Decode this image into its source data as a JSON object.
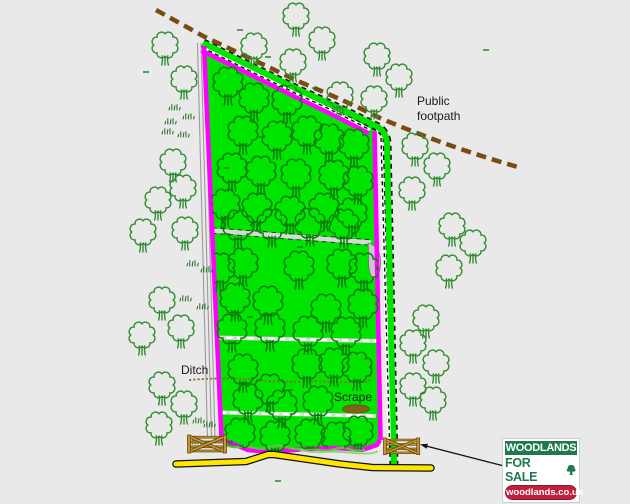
{
  "labels": [
    {
      "id": "label-public-footpath",
      "text": "Public footpath",
      "x": 417,
      "y": 94,
      "w": 60
    },
    {
      "id": "label-ditch",
      "text": "Ditch",
      "x": 181,
      "y": 363,
      "w": 42
    },
    {
      "id": "label-scrape",
      "text": "Scrape",
      "x": 334,
      "y": 390,
      "w": 50
    }
  ],
  "logo": {
    "title": "WOODLANDS",
    "subtitle": "FOR SALE",
    "url": "woodlands.co.uk"
  },
  "colors": {
    "bg": "#e9e9e9",
    "plot_green": "#00e500",
    "tree_inside": "#0a7d0a",
    "tree_outside": "#2d8c2d",
    "boundary": "#ff00ff",
    "footpath": "#7c4a12",
    "road_yellow": "#ffe600",
    "road_casing": "#111111",
    "track_grey": "#d8d8d8",
    "ditch": "#8a6d20",
    "scrub": "#5fc043",
    "gate_gold": "#c5952f",
    "gate_dark": "#553a08",
    "label_text": "#1b1b1b",
    "logo_green": "#1e7a4c",
    "logo_red": "#c2203a"
  },
  "map": {
    "tree_scale_inside": 0.92,
    "tree_scale_outside": 0.8,
    "trees_inside": [
      [
        228,
        82
      ],
      [
        254,
        98
      ],
      [
        287,
        100
      ],
      [
        243,
        131
      ],
      [
        277,
        136
      ],
      [
        307,
        131
      ],
      [
        329,
        139
      ],
      [
        354,
        144
      ],
      [
        232,
        168
      ],
      [
        261,
        171
      ],
      [
        296,
        174
      ],
      [
        334,
        175
      ],
      [
        358,
        181
      ],
      [
        225,
        204
      ],
      [
        257,
        208
      ],
      [
        290,
        211
      ],
      [
        324,
        208
      ],
      [
        352,
        213
      ],
      [
        238,
        225
      ],
      [
        272,
        224
      ],
      [
        310,
        223
      ],
      [
        344,
        224
      ],
      [
        220,
        268
      ],
      [
        243,
        263
      ],
      [
        299,
        266
      ],
      [
        342,
        264
      ],
      [
        364,
        268
      ],
      [
        235,
        298
      ],
      [
        268,
        301
      ],
      [
        326,
        309
      ],
      [
        363,
        304
      ],
      [
        232,
        329
      ],
      [
        270,
        328
      ],
      [
        308,
        331
      ],
      [
        346,
        332
      ],
      [
        243,
        369
      ],
      [
        307,
        364
      ],
      [
        334,
        363
      ],
      [
        357,
        367
      ],
      [
        270,
        389
      ],
      [
        248,
        399
      ],
      [
        282,
        405
      ],
      [
        318,
        401
      ],
      [
        240,
        433
      ],
      [
        275,
        436
      ],
      [
        310,
        434
      ],
      [
        336,
        437
      ],
      [
        358,
        431
      ]
    ],
    "trees_outside": [
      [
        165,
        45
      ],
      [
        184,
        79
      ],
      [
        254,
        46
      ],
      [
        296,
        16
      ],
      [
        293,
        62
      ],
      [
        322,
        40
      ],
      [
        377,
        56
      ],
      [
        399,
        77
      ],
      [
        340,
        95
      ],
      [
        374,
        99
      ],
      [
        173,
        162
      ],
      [
        183,
        188
      ],
      [
        158,
        200
      ],
      [
        185,
        230
      ],
      [
        143,
        232
      ],
      [
        162,
        300
      ],
      [
        142,
        335
      ],
      [
        181,
        328
      ],
      [
        162,
        385
      ],
      [
        184,
        404
      ],
      [
        159,
        425
      ],
      [
        415,
        146
      ],
      [
        437,
        166
      ],
      [
        412,
        190
      ],
      [
        452,
        226
      ],
      [
        473,
        243
      ],
      [
        449,
        268
      ],
      [
        426,
        318
      ],
      [
        413,
        343
      ],
      [
        436,
        363
      ],
      [
        413,
        386
      ],
      [
        433,
        400
      ]
    ],
    "tufts": [
      [
        175,
        107
      ],
      [
        189,
        116
      ],
      [
        171,
        121
      ],
      [
        184,
        134
      ],
      [
        168,
        131
      ],
      [
        193,
        263
      ],
      [
        207,
        269
      ],
      [
        186,
        298
      ],
      [
        203,
        306
      ],
      [
        199,
        420
      ],
      [
        210,
        424
      ],
      [
        196,
        441
      ],
      [
        230,
        443
      ]
    ],
    "dashes": [
      [
        146,
        72
      ],
      [
        240,
        30
      ],
      [
        268,
        57
      ],
      [
        315,
        88
      ],
      [
        486,
        50
      ],
      [
        262,
        137
      ],
      [
        226,
        168
      ],
      [
        300,
        247
      ],
      [
        250,
        317
      ],
      [
        290,
        390
      ],
      [
        278,
        481
      ]
    ],
    "gates": [
      {
        "x": 187,
        "y": 434,
        "s": 1.0
      },
      {
        "x": 383,
        "y": 437,
        "s": 0.93
      }
    ]
  }
}
